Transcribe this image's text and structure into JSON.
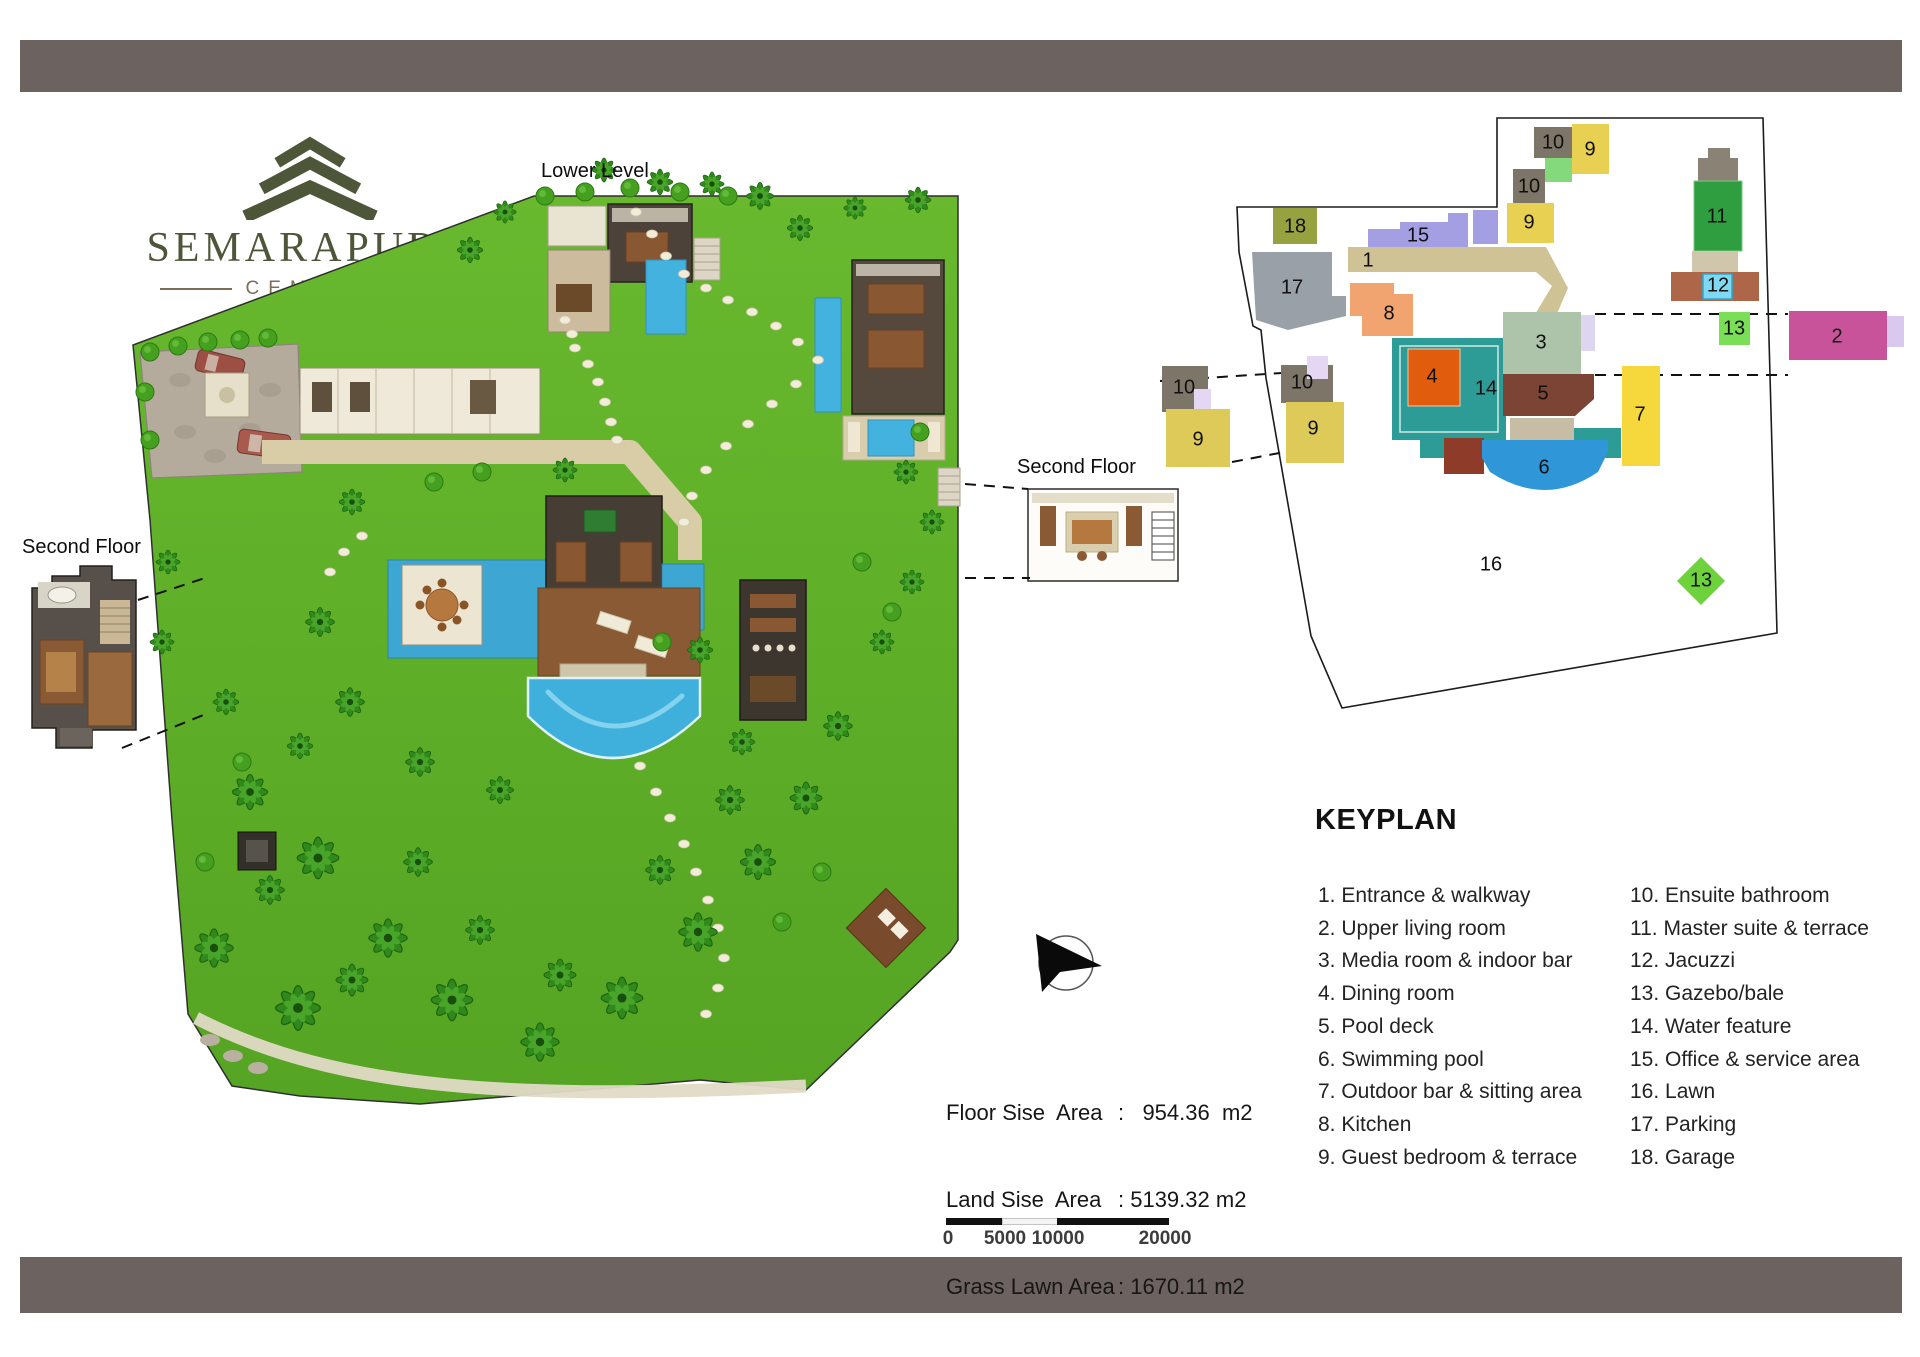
{
  "logo": {
    "name": "SEMARAPURA",
    "subtitle": "CEMAGI"
  },
  "plan_labels": {
    "lower_level": "Lower Level",
    "second_floor_left": "Second Floor",
    "second_floor_right": "Second Floor"
  },
  "keyplan": {
    "title": "KEYPLAN",
    "legend_left": [
      "1. Entrance & walkway",
      "2. Upper living room",
      "3. Media room & indoor bar",
      "4. Dining room",
      "5. Pool deck",
      "6. Swimming pool",
      "7. Outdoor bar & sitting area",
      "8. Kitchen",
      "9. Guest bedroom & terrace"
    ],
    "legend_right": [
      "10. Ensuite bathroom",
      "11. Master suite & terrace",
      "12. Jacuzzi",
      "13. Gazebo/bale",
      "14. Water feature",
      "15. Office & service area",
      "16. Lawn",
      "17. Parking",
      "18. Garage"
    ],
    "blocks": {
      "b18": "18",
      "b17": "17",
      "b15": "15",
      "b1": "1",
      "b8": "8",
      "b10a": "10",
      "b9a": "9",
      "b10b": "10",
      "b9b": "9",
      "b11": "11",
      "b12": "12",
      "b13a": "13",
      "b2": "2",
      "b3": "3",
      "b5": "5",
      "b4": "4",
      "b14": "14",
      "b7": "7",
      "b6": "6",
      "b16": "16",
      "b13b": "13",
      "b10c": "10",
      "b9c": "9",
      "b10d": "10",
      "b9d": "9"
    }
  },
  "stats": {
    "rows": [
      {
        "label": "Floor Sise  Area",
        "value": ":   954.36  m2"
      },
      {
        "label": "Land Sise  Area",
        "value": ": 5139.32 m2"
      },
      {
        "label": "Grass Lawn Area",
        "value": ": 1670.11 m2"
      }
    ]
  },
  "scale_bar": {
    "ticks": [
      "0",
      "5000",
      "10000",
      "20000"
    ]
  },
  "colors": {
    "banner": "#6c6260",
    "logo_green": "#4d5638",
    "logo_brown": "#7d6e57",
    "lawn": "#61b12a",
    "pool_blue": "#3fb0dc",
    "kp_garage": "#96a23f",
    "kp_parking": "#9aa0a8",
    "kp_office": "#a49fe3",
    "kp_walkway": "#cfc294",
    "kp_kitchen": "#f2a470",
    "kp_ensuite": "#7d7568",
    "kp_guest": "#e8d052",
    "kp_master": "#2f9e40",
    "kp_jacuzzi": "#7fd9f2",
    "kp_gazebo": "#7ade57",
    "kp_upper_living": "#c8539a",
    "kp_media": "#adc3aa",
    "kp_pool_deck": "#7b4434",
    "kp_dining": "#e25c0e",
    "kp_water_feature": "#2d9c96",
    "kp_outdoor_bar": "#f6d83c",
    "kp_pool": "#2f97d8"
  }
}
